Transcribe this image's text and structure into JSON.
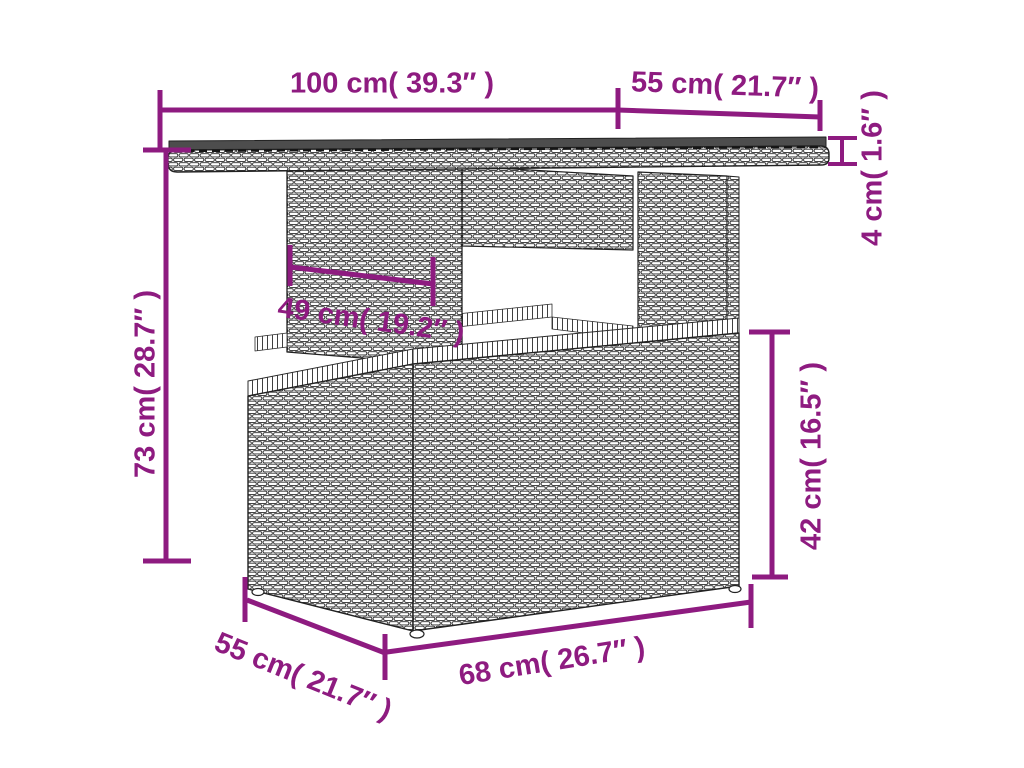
{
  "page": {
    "type": "product-dimension-diagram",
    "subject": "poly rattan garden table line drawing with dimension callouts",
    "background": "#ffffff"
  },
  "colors": {
    "accent": "#8E1B80",
    "line": "#222222",
    "glass_top": "#4d4d4d"
  },
  "labels": {
    "top_width": "100 cm( 39.3″ )",
    "top_depth": "55 cm( 21.7″ )",
    "top_thickness": "4 cm( 1.6″ )",
    "overall_height": "73 cm( 28.7″ )",
    "pedestal_width": "49 cm( 19.2″ )",
    "base_height": "42 cm( 16.5″ )",
    "base_depth": "55 cm( 21.7″ )",
    "base_width": "68 cm( 26.7″ )"
  }
}
